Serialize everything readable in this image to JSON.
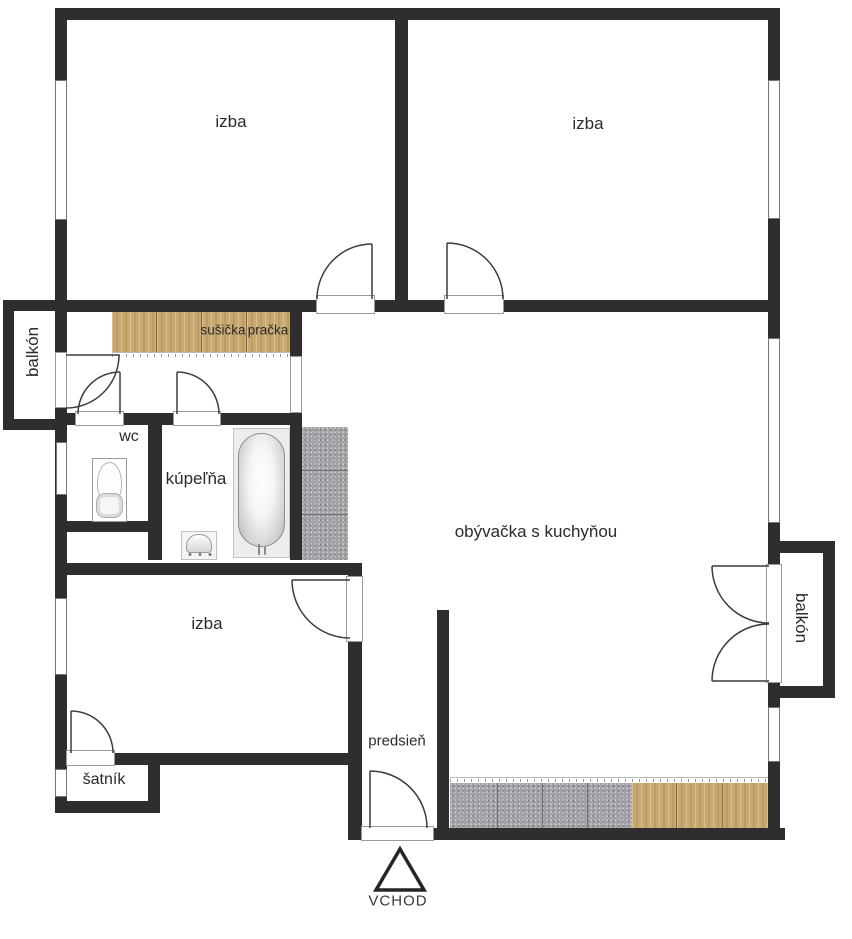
{
  "plan": {
    "labels": {
      "room_top_left": "izba",
      "room_top_right": "izba",
      "room_bottom_left": "izba",
      "living_kitchen": "obývačka s kuchyňou",
      "bathroom": "kúpeľňa",
      "wc": "wc",
      "hallway": "predsieň",
      "closet": "šatník",
      "balcony_left": "balkón",
      "balcony_right": "balkón",
      "dryer": "sušička",
      "washer": "pračka",
      "entrance": "VCHOD"
    },
    "colors": {
      "wall": "#2e2e2e",
      "wood": "#c9a96f",
      "tile": "#a2a2a7",
      "text": "#2b2b2b"
    },
    "icons": {
      "toilet": "toilet-icon",
      "bathtub": "bathtub-icon",
      "sink": "sink-icon",
      "entrance_arrow": "entrance-triangle-icon"
    }
  }
}
